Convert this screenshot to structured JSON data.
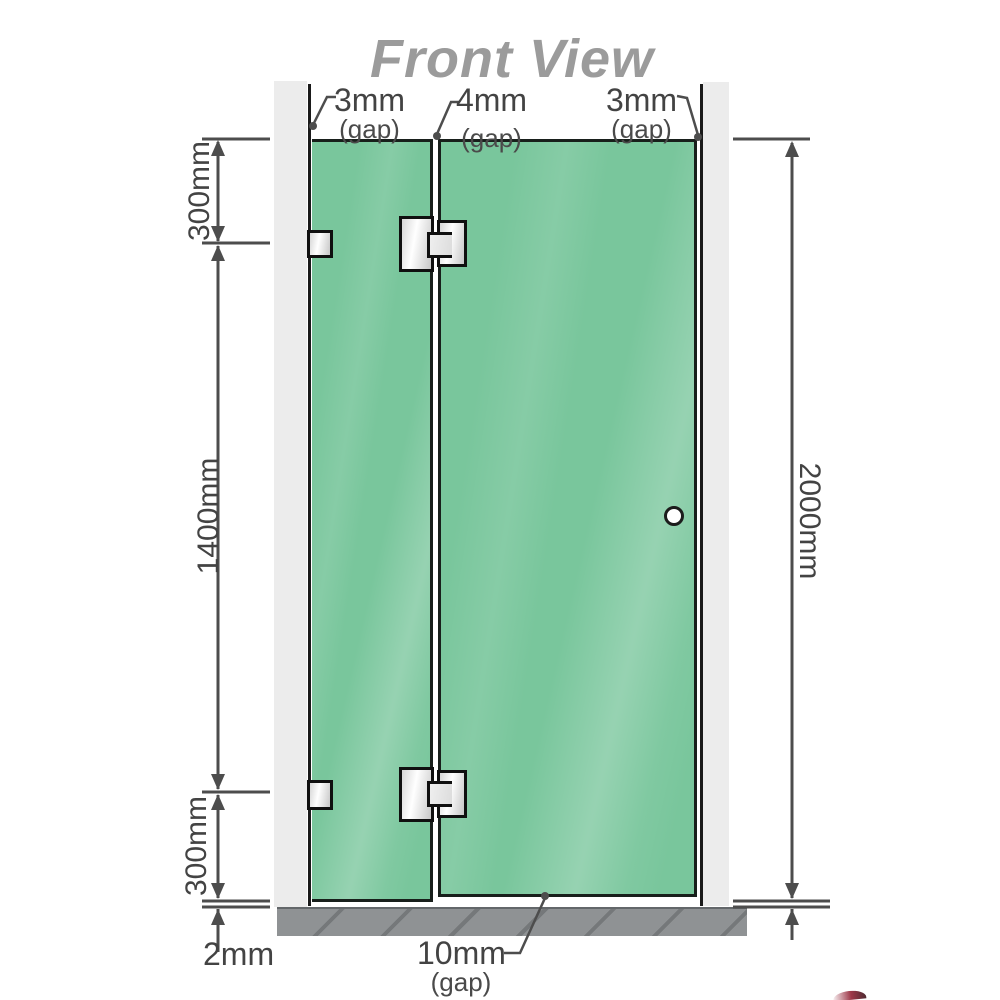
{
  "title": "Front View",
  "colors": {
    "glass": "#79c69c",
    "frame": "#ececec",
    "floor": "#8f9294",
    "dim": "#4d4d4d",
    "titlecol": "#9b9b9b",
    "accent": "#8c1428"
  },
  "dims": {
    "top_gaps": [
      {
        "value": "3mm",
        "suffix": "(gap)"
      },
      {
        "value": "4mm",
        "suffix": "(gap)"
      },
      {
        "value": "3mm",
        "suffix": "(gap)"
      }
    ],
    "left": [
      "300mm",
      "1400mm",
      "300mm"
    ],
    "floor_offset": "2mm",
    "right_total": "2000mm",
    "bottom_gap": {
      "value": "10mm",
      "suffix": "(gap)"
    }
  }
}
